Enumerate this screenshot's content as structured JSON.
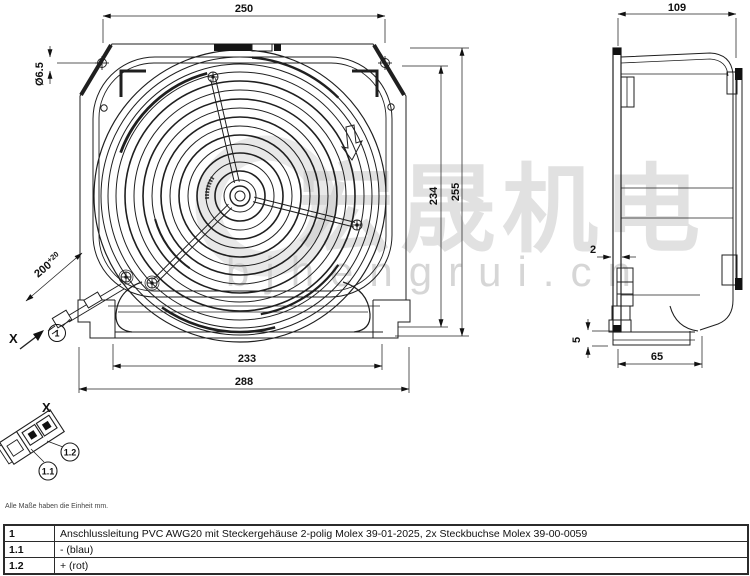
{
  "watermark": {
    "cjk": "宏晟机电",
    "domain": "bjhengrui.cn"
  },
  "dimensions": {
    "front_width": "250",
    "hole_dia": "Ø6.5",
    "inner_height": "234",
    "outer_height": "255",
    "inner_width": "233",
    "outer_width": "288",
    "cable_length": "200",
    "cable_tolerance": "+20",
    "depth": "109",
    "flange_thickness": "2",
    "foot_height": "5",
    "base_depth": "65"
  },
  "labels": {
    "view_arrow": "X",
    "detail_view": "X",
    "balloon_item": "1",
    "balloon_neg": "1.1",
    "balloon_pos": "1.2"
  },
  "note": "Alle Maße haben die Einheit mm.",
  "table": {
    "rows": [
      {
        "id": "1",
        "text": "Anschlussleitung PVC AWG20 mit Steckergehäuse 2-polig Molex 39-01-2025, 2x Steckbuchse Molex 39-00-0059"
      },
      {
        "id": "1.1",
        "text": "- (blau)"
      },
      {
        "id": "1.2",
        "text": "+ (rot)"
      }
    ]
  }
}
